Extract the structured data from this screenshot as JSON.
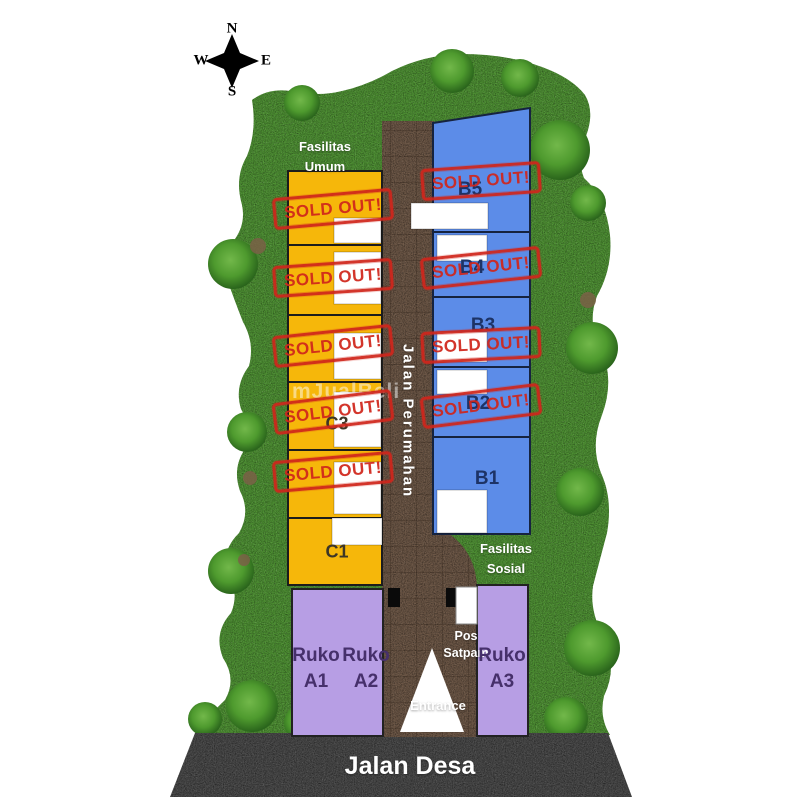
{
  "compass": {
    "north": "N",
    "south": "S",
    "east": "E",
    "west": "W"
  },
  "labels": {
    "fasilitas_umum_line1": "Fasilitas",
    "fasilitas_umum_line2": "Umum",
    "fasilitas_sosial_line1": "Fasilitas",
    "fasilitas_sosial_line2": "Sosial",
    "street_internal": "Jalan Perumahan",
    "street_main": "Jalan Desa",
    "entrance": "Entrance",
    "guard_post_line1": "Pos",
    "guard_post_line2": "Satpam",
    "watermark": "mJualBeli"
  },
  "stamp_text": "SOLD OUT!",
  "colors": {
    "grass": "#4E9133",
    "lot_yellow": "#F6B70A",
    "lot_blue": "#5C8CE8",
    "lot_purple": "#B79EE4",
    "road_brown": "#6E5847",
    "road_gray": "#4B4B4B",
    "stamp_red": "#D0261C",
    "label_blue": "#1D3366",
    "label_dark": "#3D3627",
    "label_purple": "#46306B"
  },
  "blocks": {
    "left_column": {
      "rows": [
        {
          "label": "",
          "sold": true
        },
        {
          "label": "",
          "sold": true
        },
        {
          "label": "",
          "sold": true
        },
        {
          "label": "C3",
          "sold": true
        },
        {
          "label": "",
          "sold": true
        },
        {
          "label": "C1",
          "sold": false
        }
      ]
    },
    "right_column": {
      "rows": [
        {
          "label": "B5",
          "sold": true
        },
        {
          "label": "B4",
          "sold": true
        },
        {
          "label": "B3",
          "sold": true
        },
        {
          "label": "B2",
          "sold": true
        },
        {
          "label": "B1",
          "sold": false
        }
      ]
    },
    "shops": [
      {
        "line1": "Ruko",
        "line2": "A1"
      },
      {
        "line1": "Ruko",
        "line2": "A2"
      },
      {
        "line1": "Ruko",
        "line2": "A3"
      }
    ]
  }
}
